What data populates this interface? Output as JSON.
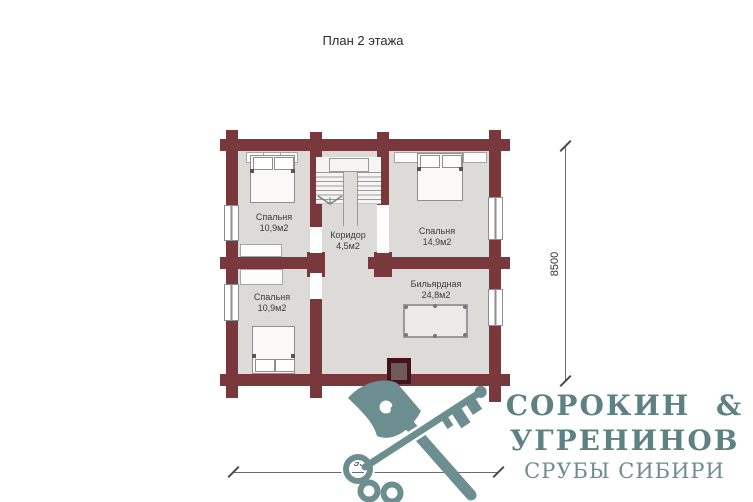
{
  "title": "План 2 этажа",
  "rooms": [
    {
      "name": "Спальня",
      "area": "10,9м2"
    },
    {
      "name": "Коридор",
      "area": "4,5м2"
    },
    {
      "name": "Спальня",
      "area": "14,9м2"
    },
    {
      "name": "Спальня",
      "area": "10,9м2"
    },
    {
      "name": "Бильярдная",
      "area": "24,8м2"
    }
  ],
  "dimensions": {
    "vertical": "8500",
    "horizontal": "9500"
  },
  "logo": {
    "line1": "СОРОКИН &",
    "line2": "УГРЕНИНОВ",
    "tagline": "СРУБЫ СИБИРИ"
  },
  "colors": {
    "wall": "#79383c",
    "floor": "#dcdbd8",
    "logo_text": "#5e8184",
    "logo_icon": "#6d8e90"
  }
}
